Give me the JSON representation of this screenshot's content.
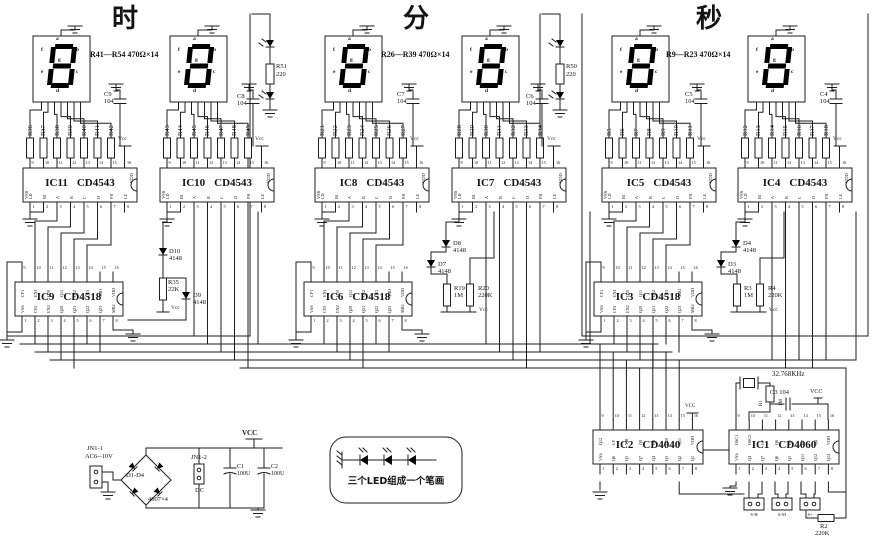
{
  "sections": [
    {
      "title": "时",
      "note": "R41—R54  470Ω×14"
    },
    {
      "title": "分",
      "note": "R26—R39  470Ω×14"
    },
    {
      "title": "秒",
      "note": "R9—R23  470Ω×14"
    }
  ],
  "displays": {
    "seg_letters": [
      "a",
      "b",
      "c",
      "d",
      "e",
      "f",
      "g"
    ]
  },
  "resistor_groups": [
    {
      "labels": [
        "R36",
        "R37",
        "R38",
        "R39",
        "R40",
        "R41",
        "R42"
      ],
      "vcc": "Vcc"
    },
    {
      "labels": [
        "R43",
        "R44",
        "R45",
        "R46",
        "R47",
        "R48",
        "R49"
      ],
      "vcc": "Vcc"
    },
    {
      "labels": [
        "R21",
        "R22",
        "R23",
        "R24",
        "R25",
        "R26",
        "R27"
      ],
      "vcc": "Vcc"
    },
    {
      "labels": [
        "R28",
        "R29",
        "R30",
        "R31",
        "R32",
        "R33",
        "R34"
      ],
      "vcc": "Vcc"
    },
    {
      "labels": [
        "R5",
        "R6",
        "R7",
        "R8",
        "R9",
        "R10",
        "R11"
      ],
      "vcc": "Vcc"
    },
    {
      "labels": [
        "R12",
        "R13",
        "R14",
        "R15",
        "R16",
        "R17",
        "R18"
      ],
      "vcc": "Vcc"
    }
  ],
  "decoders": {
    "type": "CD4543",
    "ids": [
      "IC11",
      "IC10",
      "IC8",
      "IC7",
      "IC5",
      "IC4"
    ],
    "left_pin": "VSS",
    "right_pin": "VDD",
    "top_pins": [
      "9",
      "10",
      "11",
      "12",
      "13",
      "14",
      "15",
      "16"
    ],
    "bottom_pins": [
      "1",
      "2",
      "3",
      "4",
      "5",
      "6",
      "7",
      "8"
    ],
    "bottom_labels": [
      "LD",
      "BI",
      "A",
      "B",
      "C",
      "D",
      "PH",
      "LE"
    ]
  },
  "counters": {
    "type": "CD4518",
    "ids": [
      "IC9",
      "IC6",
      "IC3"
    ],
    "top_labels": [
      "CP1",
      "EN1",
      "Q10",
      "Q11",
      "Q12",
      "Q13",
      "MR1",
      "VDD"
    ],
    "bottom_labels": [
      "VSS",
      "CP2",
      "EN2",
      "Q20",
      "Q21",
      "Q22",
      "Q23",
      "MR2"
    ],
    "top_pins": [
      "9",
      "10",
      "11",
      "12",
      "13",
      "14",
      "15",
      "16"
    ],
    "bottom_pins": [
      "1",
      "2",
      "3",
      "4",
      "5",
      "6",
      "7",
      "8"
    ]
  },
  "colons": [
    {
      "ref": "R51",
      "value": "220"
    },
    {
      "ref": "R50",
      "value": "220"
    }
  ],
  "caps": [
    {
      "ref": "C9",
      "value": "104"
    },
    {
      "ref": "C8",
      "value": "104"
    },
    {
      "ref": "C7",
      "value": "104"
    },
    {
      "ref": "C6",
      "value": "104"
    },
    {
      "ref": "C5",
      "value": "104"
    },
    {
      "ref": "C4",
      "value": "104"
    }
  ],
  "clusters": {
    "hour": {
      "d1": "D10",
      "d1v": "4148",
      "r": "R35",
      "rv": "22K",
      "d2": "D9",
      "d2v": "4148",
      "vcc": "Vcc"
    },
    "minute": {
      "d1": "D8",
      "d1v": "4148",
      "d2": "D7",
      "d2v": "4148",
      "r1": "R19",
      "r1v": "1M",
      "r2": "R20",
      "r2v": "220K",
      "vcc": "Vcc"
    },
    "second": {
      "d1": "D4",
      "d1v": "4148",
      "d2": "D3",
      "d2v": "4148",
      "r1": "R3",
      "r1v": "1M",
      "r2": "R4",
      "r2v": "220K",
      "vcc": "Vcc"
    }
  },
  "power": {
    "conn1": "JN1-1",
    "conn1_sub": "AC6--10V",
    "bridge": "D1-D4",
    "bridge_part": "4007×4",
    "conn2": "JN1-2",
    "conn2_sub": "DC",
    "c1": "C1",
    "c1v": "100U",
    "c2": "C2",
    "c2v": "100U",
    "vcc": "VCC"
  },
  "led_note": "三个LED组成一个笔画",
  "osc": {
    "ic2_id": "IC2",
    "ic2_type": "CD4040",
    "ic1_id": "IC1",
    "ic1_type": "CD4060",
    "xtal": "32.768KHz",
    "r1": "R1",
    "r1v": "1M",
    "c3": "C3  104",
    "vcc": "VCC",
    "r2": "R2",
    "r2v": "220K",
    "switches": [
      "S-H",
      "S-M",
      "S+"
    ],
    "ic2_top": [
      "Q12",
      "CP",
      "MR",
      "Q9",
      "Q8",
      "Q10",
      "Q11",
      "VDD"
    ],
    "ic2_bottom": [
      "VSS",
      "Q6",
      "Q5",
      "Q7",
      "Q4",
      "Q3",
      "Q2",
      "Q1"
    ],
    "ic1_top": [
      "OSC1",
      "OSC2",
      "CP",
      "Q6",
      "Q5",
      "Q7",
      "Q4",
      "VDD"
    ],
    "ic1_bottom": [
      "VSS",
      "Q4",
      "Q7",
      "Q6",
      "Q5",
      "Q11",
      "Q12",
      "Q14"
    ],
    "top_pins": [
      "9",
      "10",
      "11",
      "12",
      "13",
      "14",
      "15",
      "16"
    ],
    "bottom_pins": [
      "1",
      "2",
      "3",
      "4",
      "5",
      "6",
      "7",
      "8"
    ]
  }
}
